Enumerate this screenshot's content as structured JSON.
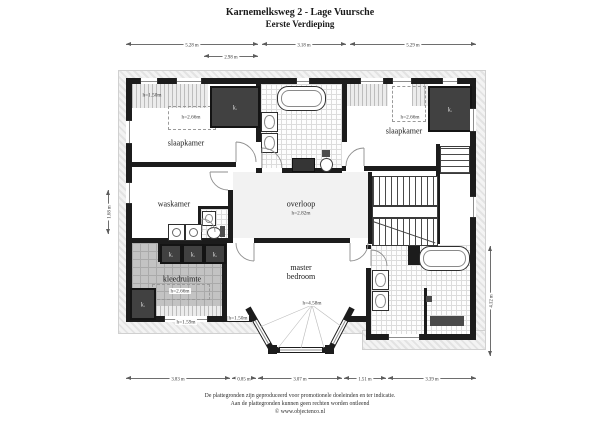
{
  "title": "Karnemelksweg 2 - Lage Vuursche",
  "subtitle": "Eerste Verdieping",
  "rooms": {
    "slaapkamer_left": {
      "label": "slaapkamer",
      "height": "h=2.66m"
    },
    "slaapkamer_right": {
      "label": "slaapkamer",
      "height": "h=2.66m"
    },
    "waskamer": {
      "label": "waskamer"
    },
    "overloop": {
      "label": "overloop",
      "height": "h=2.82m"
    },
    "kleedruimte": {
      "label": "kleedruimte",
      "height": "h=2.66m"
    },
    "master_bedroom": {
      "label_line1": "master",
      "label_line2": "bedroom",
      "height": "h=4.58m"
    }
  },
  "annotations": {
    "closet": "k.",
    "low_ceiling_top_left": "h=1.50m",
    "low_ceiling_bottom_left": "h=1.59m",
    "low_ceiling_bottom_center": "h=1.50m"
  },
  "dimensions": {
    "top": [
      "5.28 m",
      "3.18 m",
      "5.29 m"
    ],
    "top_inner": "2.98 m",
    "bottom": [
      "3.83 m",
      "0.85 m",
      "3.07 m",
      "1.51 m",
      "3.39 m"
    ],
    "left": "1.68 m",
    "right": "4.12 m"
  },
  "footer": {
    "line1": "De plattegronden zijn geproduceerd voor promotionele doeleinden en ter indicatie.",
    "line2": "Aan de plattegronden kunnen geen rechten worden ontleend",
    "line3": "© www.objectenco.nl"
  }
}
